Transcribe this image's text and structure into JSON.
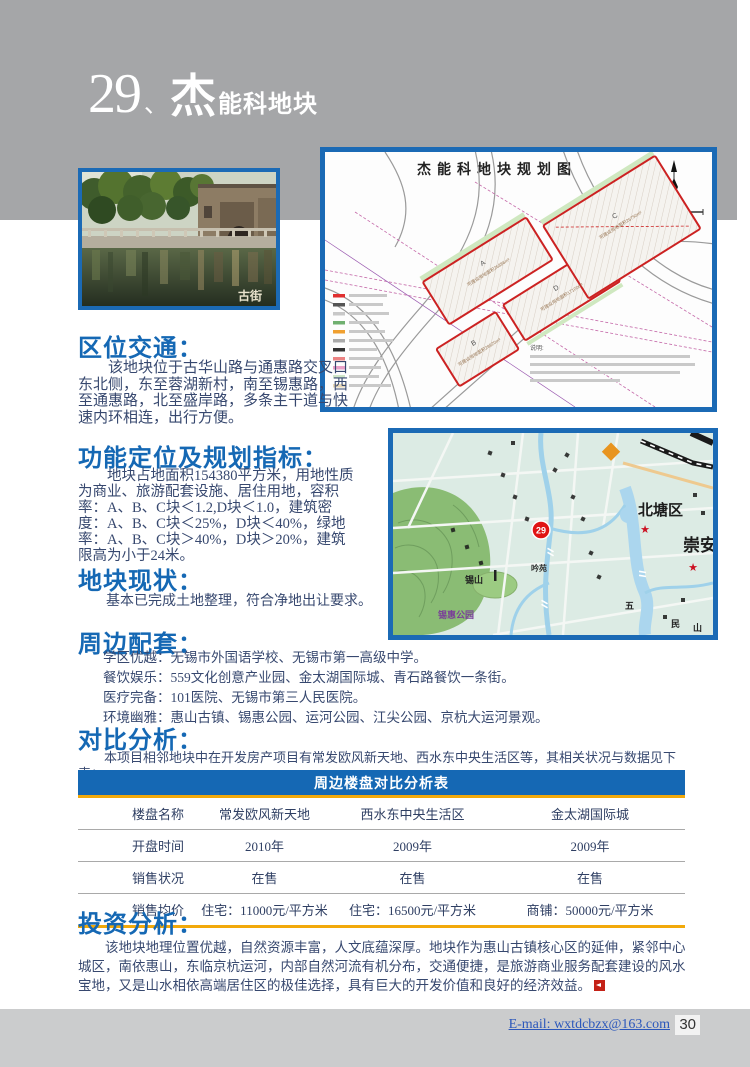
{
  "header": {
    "number": "29",
    "comma": "、",
    "big_char": "杰",
    "rest": "能科地块"
  },
  "photo": {
    "caption": "古街"
  },
  "plan_map": {
    "title": "杰能科地块规划图",
    "parcels": [
      {
        "id": "A",
        "area": "可建设用地面积26886m²"
      },
      {
        "id": "B",
        "area": "可建设用地面积28920m²"
      },
      {
        "id": "C",
        "area": "可建设用地面积26750m²"
      },
      {
        "id": "D",
        "area": "可建设用地面积17100m²"
      }
    ],
    "notes_label": "说明:"
  },
  "city_map": {
    "marker": "29",
    "district_label": "北塘区",
    "district_label2": "崇安",
    "hill_label": "锡山",
    "park_label": "锡惠公园",
    "garden_label": "吟苑",
    "char_a": "五",
    "char_b": "民",
    "char_c": "山"
  },
  "sections": {
    "location": {
      "heading": "区位交通：",
      "body": "该地块位于古华山路与通惠路交叉口东北侧，东至蓉湖新村，南至锡惠路，西至通惠路，北至盛岸路，多条主干道与快速内环相连，出行方便。"
    },
    "planning": {
      "heading": "功能定位及规划指标：",
      "body": "地块占地面积154380平方米，用地性质为商业、旅游配套设施、居住用地，容积率：A、B、C块＜1.2,D块＜1.0，建筑密度：A、B、C块＜25%，D块＜40%，绿地率：A、B、C块＞40%，D块＞20%，建筑限高为小于24米。"
    },
    "status": {
      "heading": "地块现状：",
      "body": "基本已完成土地整理，符合净地出让要求。"
    },
    "surroundings": {
      "heading": "周边配套：",
      "items": [
        "学区优越：无锡市外国语学校、无锡市第一高级中学。",
        "餐饮娱乐：559文化创意产业园、金太湖国际城、青石路餐饮一条街。",
        "医疗完备：101医院、无锡市第三人民医院。",
        "环境幽雅：惠山古镇、锡惠公园、运河公园、江尖公园、京杭大运河景观。"
      ]
    },
    "comparison": {
      "heading": "对比分析：",
      "intro": "本项目相邻地块中在开发房产项目有常发欧风新天地、西水东中央生活区等，其相关状况与数据见下表：",
      "table": {
        "title": "周边楼盘对比分析表",
        "rows": [
          [
            "楼盘名称",
            "常发欧风新天地",
            "西水东中央生活区",
            "金太湖国际城"
          ],
          [
            "开盘时间",
            "2010年",
            "2009年",
            "2009年"
          ],
          [
            "销售状况",
            "在售",
            "在售",
            "在售"
          ],
          [
            "销售均价",
            "住宅：11000元/平方米",
            "住宅：16500元/平方米",
            "商铺：50000元/平方米"
          ]
        ]
      }
    },
    "investment": {
      "heading": "投资分析：",
      "body": "该地块地理位置优越，自然资源丰富，人文底蕴深厚。地块作为惠山古镇核心区的延伸，紧邻中心城区，南依惠山，东临京杭运河，内部自然河流有机分布，交通便捷，是旅游商业服务配套建设的风水宝地，又是山水相依高端居住区的极佳选择，具有巨大的开发价值和良好的经济效益。"
    }
  },
  "footer": {
    "email": "E-mail: wxtdcbzx@163.com",
    "page_number": "30"
  }
}
